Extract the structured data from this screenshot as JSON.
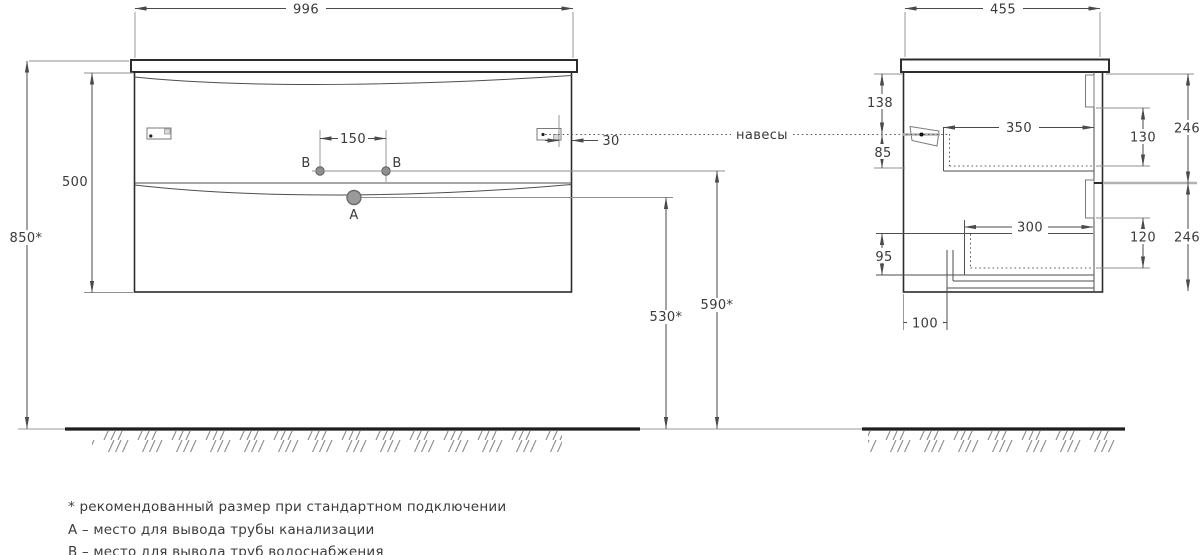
{
  "front": {
    "width": "996",
    "height": "500",
    "mount_height": "850*",
    "holes_spacing": "150",
    "hanger_inset": "30",
    "hole_a": "A",
    "hole_b_left": "B",
    "hole_b_right": "B",
    "drain_height": "530*",
    "supply_height": "590*"
  },
  "side": {
    "depth": "455",
    "top_gap": "138",
    "hanger_drop": "85",
    "upper_depth": "350",
    "upper_height": "130",
    "upper_front": "246",
    "lower_depth": "300",
    "lower_height": "120",
    "lower_front": "246",
    "bottom_zone": "95",
    "pipe_offset": "100"
  },
  "labels": {
    "hangers": "навесы"
  },
  "footnotes": [
    "* рекомендованный размер при стандартном подключении",
    "А – место для вывода трубы канализации",
    "В – место для вывода труб водоснабжения"
  ],
  "colors": {
    "outline": "#2c2c2c",
    "dimension_line": "#4a4a4a",
    "text": "#3a3a3a",
    "hatch": "#8a8a8a",
    "divider_gray": "#b2b2b2",
    "background": "#ffffff"
  }
}
